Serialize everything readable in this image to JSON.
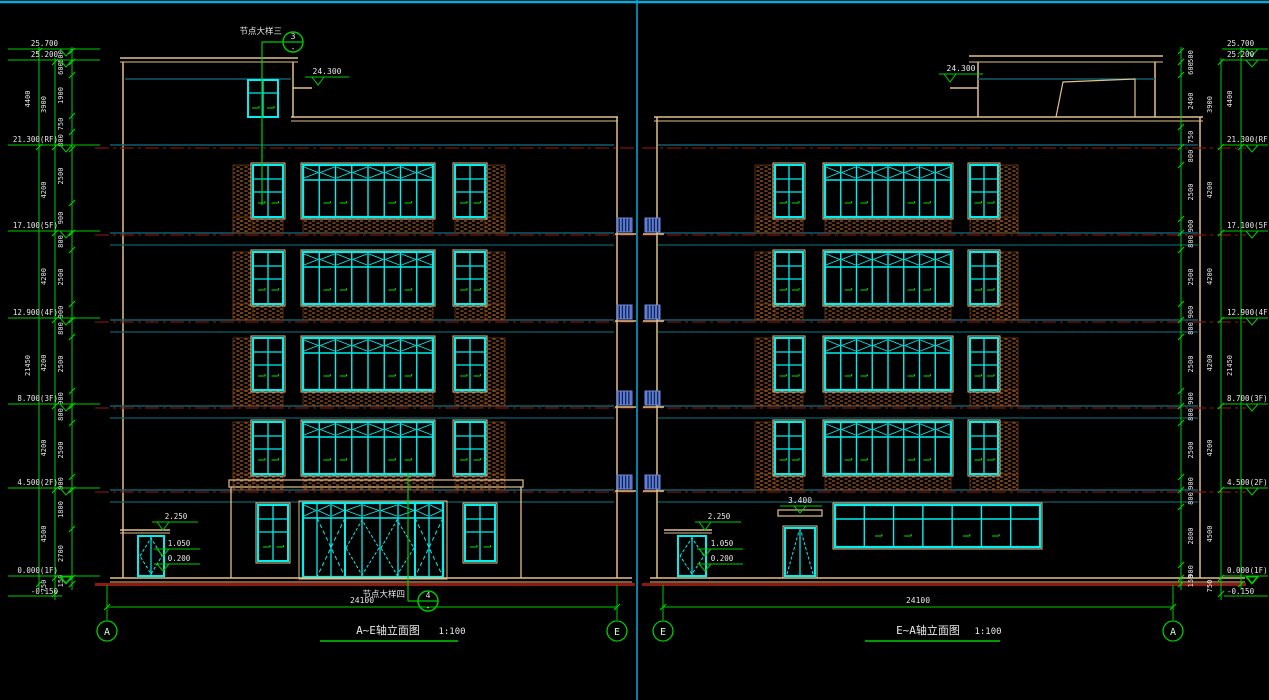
{
  "left_view": {
    "title": "A~E轴立面图",
    "scale": "1:100",
    "axis_start": "A",
    "axis_end": "E",
    "span": "24100",
    "roof_level": "24.300",
    "levels": [
      "25.700",
      "25.200",
      "21.300(RF)",
      "17.100(5F)",
      "12.900(4F)",
      "8.700(3F)",
      "4.500(2F)",
      "0.000(1F)",
      "-0.150"
    ],
    "dim_inner": [
      "500",
      "600",
      "1900",
      "750",
      "800",
      "2500",
      "900",
      "800",
      "2500",
      "900",
      "800",
      "2500",
      "900",
      "800",
      "2500",
      "900",
      "1800",
      "2700",
      "150"
    ],
    "dim_mid": [
      "3900",
      "4200",
      "4200",
      "4200",
      "4200",
      "4500",
      "750"
    ],
    "dim_outer": [
      "4400",
      "21450"
    ],
    "side_door_levels": [
      "2.250",
      "1.050",
      "0.200"
    ],
    "callout_top": {
      "num": "3",
      "sheet": "-",
      "label": "节点大样三"
    },
    "callout_bottom": {
      "num": "4",
      "sheet": "-",
      "label": "节点大样四"
    }
  },
  "right_view": {
    "title": "E~A轴立面图",
    "scale": "1:100",
    "axis_start": "E",
    "axis_end": "A",
    "span": "24100",
    "roof_level": "24.300",
    "door_level": "3.400",
    "levels": [
      "25.700",
      "25.200",
      "21.300(RF)",
      "17.100(5F)",
      "12.900(4F)",
      "8.700(3F)",
      "4.500(2F)",
      "0.000(1F)",
      "-0.150"
    ],
    "dim_inner": [
      "500",
      "600",
      "2400",
      "750",
      "800",
      "2500",
      "900",
      "800",
      "2500",
      "900",
      "800",
      "2500",
      "900",
      "800",
      "2500",
      "900",
      "800",
      "2800",
      "900",
      "150"
    ],
    "dim_mid": [
      "3900",
      "4200",
      "4200",
      "4200",
      "4200",
      "4500",
      "750"
    ],
    "dim_outer": [
      "4400",
      "21450"
    ],
    "side_door_levels": [
      "2.250",
      "1.050",
      "0.200"
    ]
  },
  "colors": {
    "background": "#000000",
    "dim_green": "#00CC00",
    "window_cyan": "#00F0F0",
    "wall_wheat": "#E2C089",
    "beam_teal": "#0E5F6E",
    "axis_red": "#8B1A10",
    "dashdot_red": "#7E140E",
    "brick": "#9C5220",
    "louver_blue": "#5C7EDC",
    "text_white": "#E8E8E8",
    "sheet_border_cyan": "#00AEE0"
  }
}
